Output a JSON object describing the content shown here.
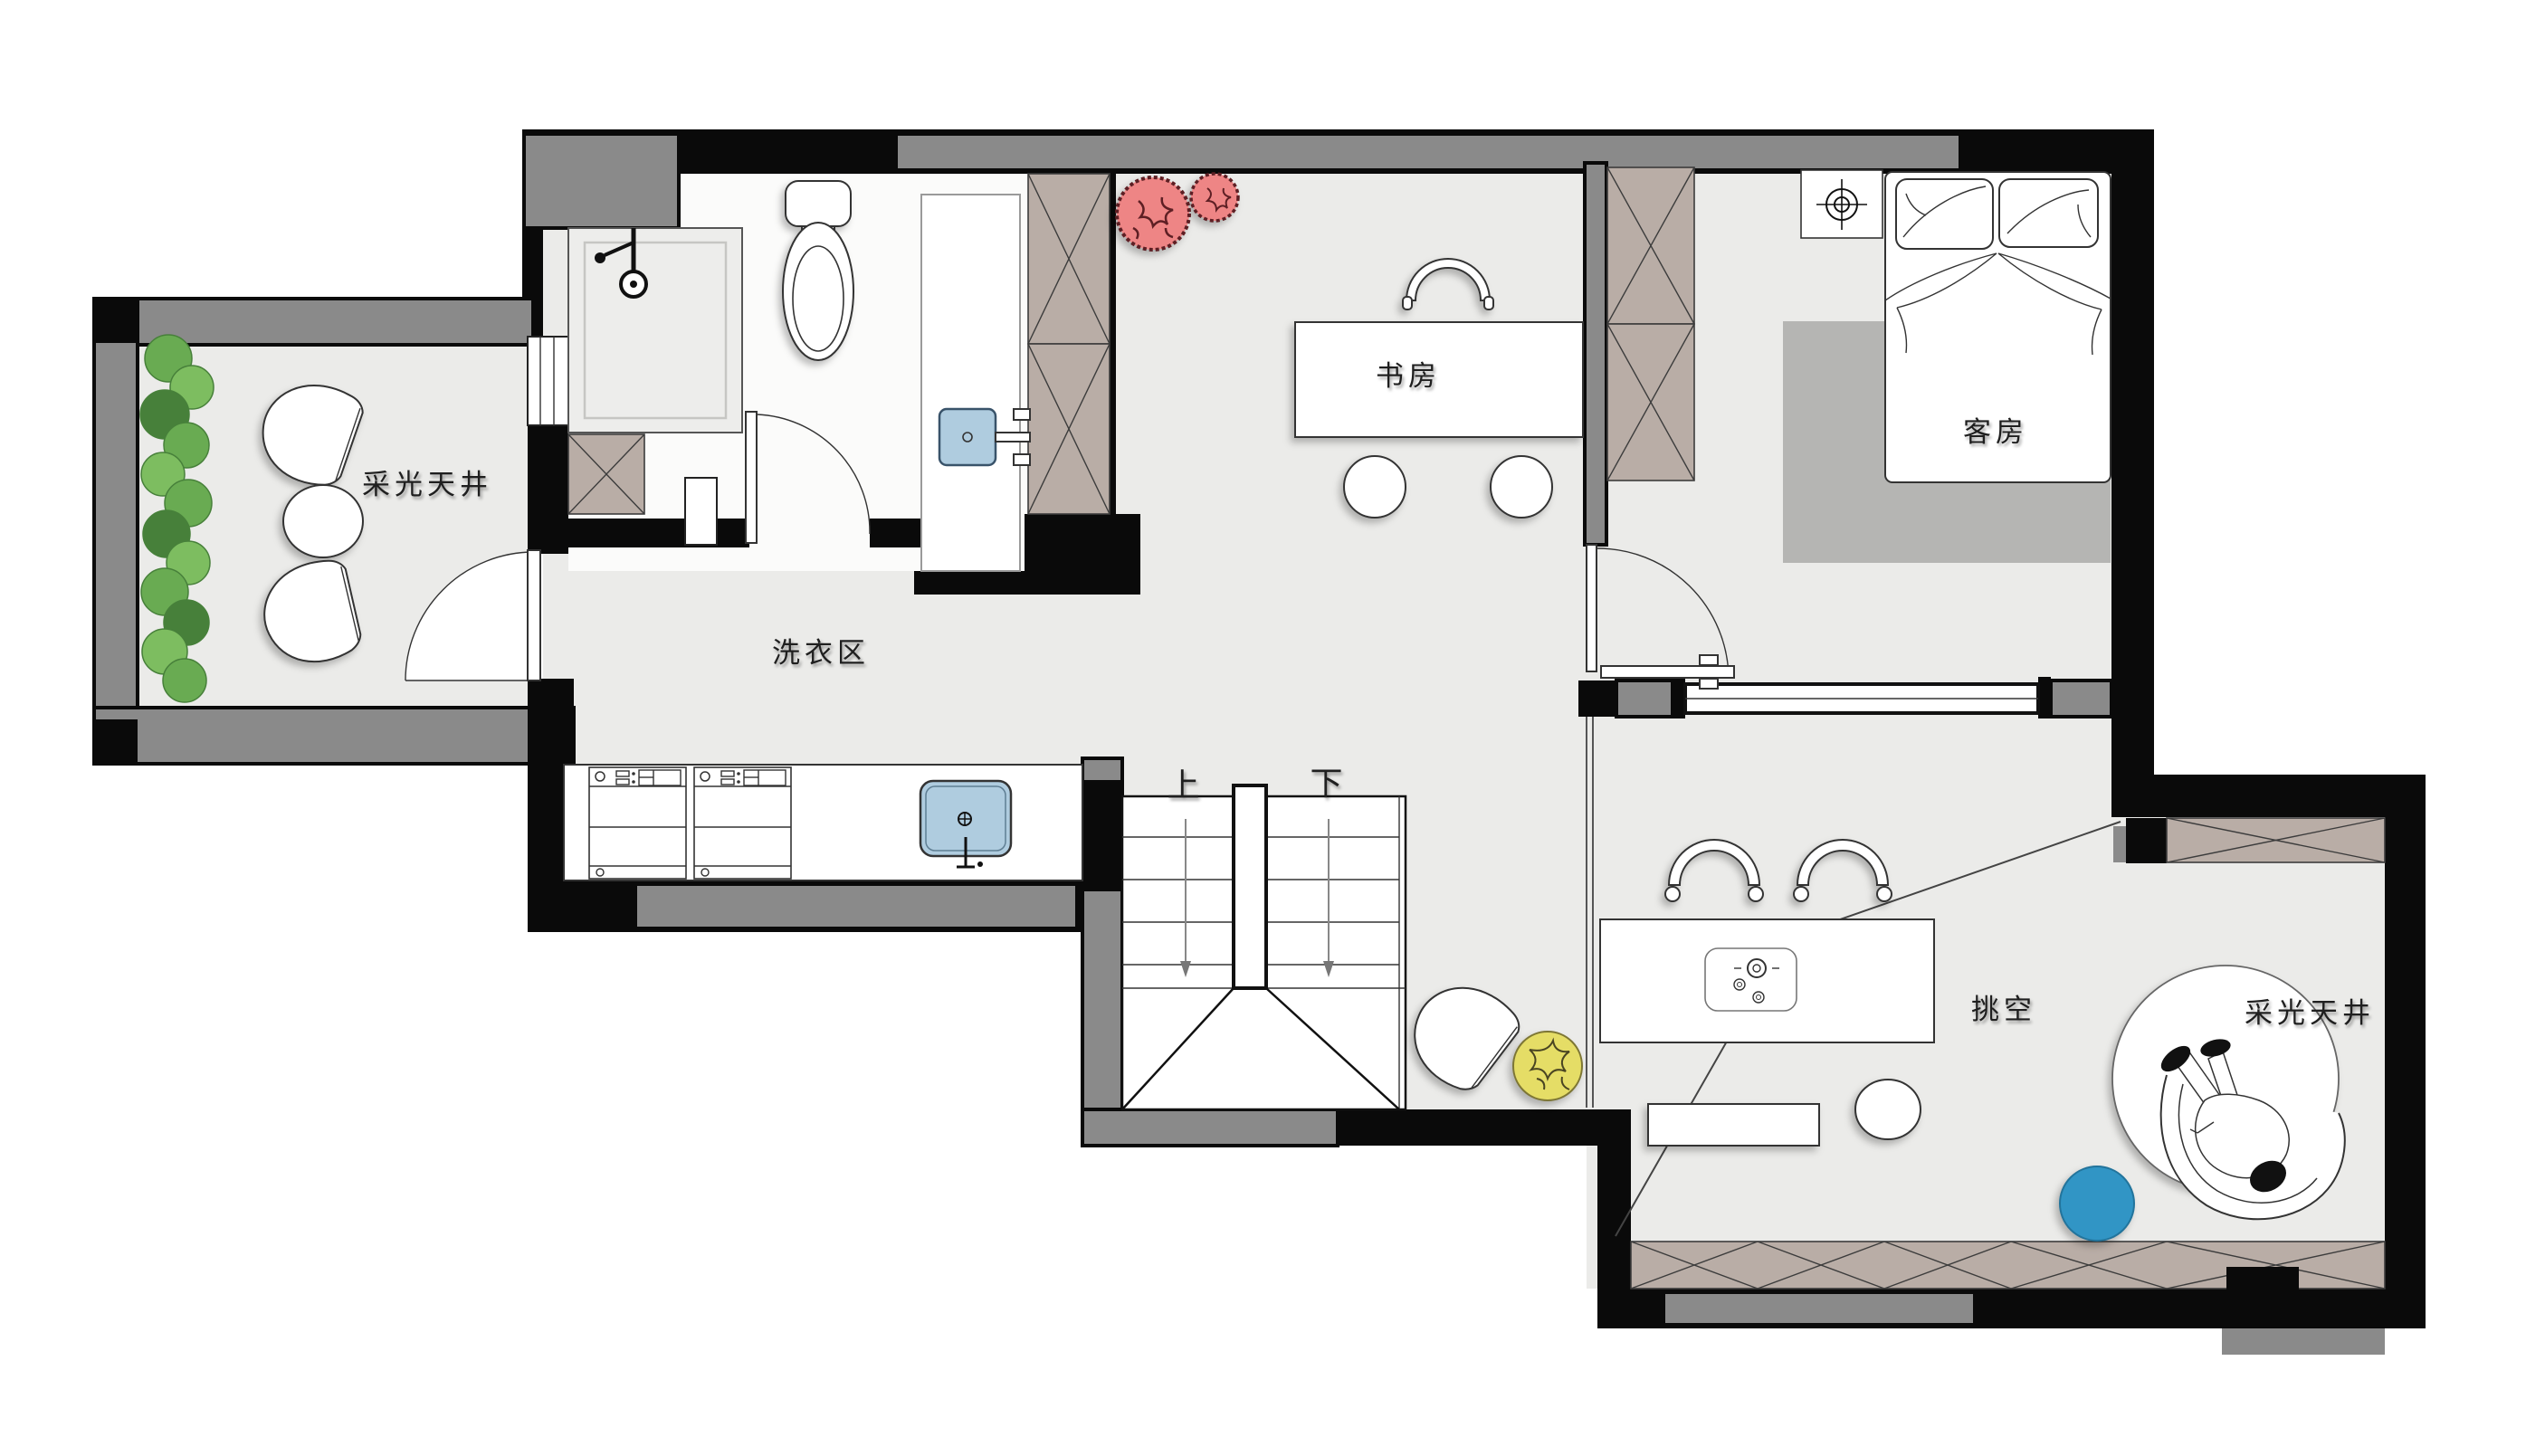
{
  "labels": {
    "skylight_left": "采光天井",
    "laundry": "洗衣区",
    "study": "书房",
    "guest_room": "客房",
    "stairs_up": "上",
    "stairs_down": "下",
    "void": "挑空",
    "skylight_right": "采光天井"
  },
  "colors": {
    "floor": "#ebebe9",
    "floor_white": "#fbfbfa",
    "wall_gray": "#8a8a8a",
    "wall_black": "#0a0a0a",
    "cabinet_tan": "#b9ada6",
    "rug_gray": "#b5b5b3",
    "sink_blue": "#afccdf",
    "accent_blue": "#3195c5",
    "accent_yellow": "#e5dd66",
    "accent_red": "#ee8585",
    "hedge_green": "#69ab52",
    "hedge_green_dark": "#47803a",
    "line": "#333333",
    "text": "#1f1f1f"
  }
}
